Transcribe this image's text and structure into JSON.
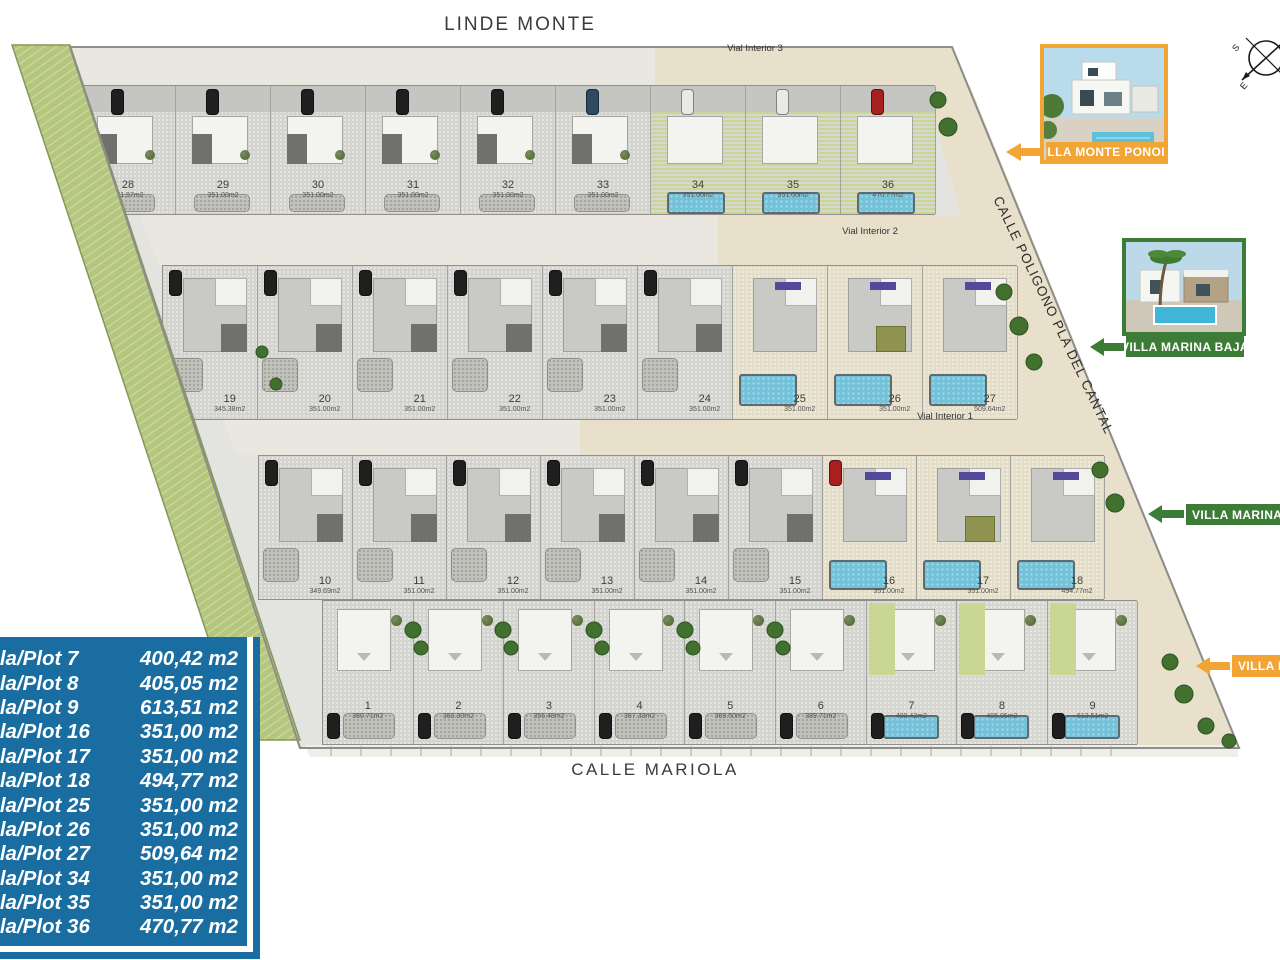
{
  "streets": {
    "top": "LINDE MONTE",
    "bottom": "CALLE MARIOLA",
    "right": "CALLE POLIGONO PLA DEL CANTAL"
  },
  "vials": {
    "v1": "Vial Interior 1",
    "v2": "Vial Interior 2",
    "v3": "Vial Interior 3"
  },
  "compass": {
    "letter_s": "S",
    "letter_e": "E"
  },
  "banners": {
    "monte_top": "VILLA MONTE PONOIG",
    "marina_top": "VILLA MARINA BAJA",
    "marina_side": "VILLA MARINA BAJA",
    "monte_side": "VILLA MONTE PONOIG"
  },
  "colors": {
    "orange": "#F2A434",
    "green": "#3D7C36",
    "legend_blue": "#1A6DA0",
    "pool": "#74C2DA",
    "lawn": "#C9D694"
  },
  "legend": {
    "rows": [
      {
        "label": "Parcela/Plot 7",
        "value": "400,42 m2"
      },
      {
        "label": "Parcela/Plot 8",
        "value": "405,05 m2"
      },
      {
        "label": "Parcela/Plot 9",
        "value": "613,51 m2"
      },
      {
        "label": "Parcela/Plot 16",
        "value": "351,00 m2"
      },
      {
        "label": "Parcela/Plot 17",
        "value": "351,00 m2"
      },
      {
        "label": "Parcela/Plot 18",
        "value": "494,77 m2"
      },
      {
        "label": "Parcela/Plot 25",
        "value": "351,00 m2"
      },
      {
        "label": "Parcela/Plot 26",
        "value": "351,00 m2"
      },
      {
        "label": "Parcela/Plot 27",
        "value": "509,64 m2"
      },
      {
        "label": "Parcela/Plot 34",
        "value": "351,00 m2"
      },
      {
        "label": "Parcela/Plot 35",
        "value": "351,00 m2"
      },
      {
        "label": "Parcela/Plot 36",
        "value": "470,77 m2"
      }
    ]
  },
  "plan": {
    "rows": [
      {
        "id": "row-28-36",
        "plots": [
          {
            "n": "28",
            "area": "371.97m2",
            "car": "#1f1f1f"
          },
          {
            "n": "29",
            "area": "351.00m2",
            "car": "#1f1f1f"
          },
          {
            "n": "30",
            "area": "351.00m2",
            "car": "#1f1f1f"
          },
          {
            "n": "31",
            "area": "351.00m2",
            "car": "#1f1f1f"
          },
          {
            "n": "32",
            "area": "351.00m2",
            "car": "#1f1f1f"
          },
          {
            "n": "33",
            "area": "351.00m2",
            "car": "#2e4a63"
          },
          {
            "n": "34",
            "area": "351.00m2",
            "car": "#e9e9e7",
            "green": true
          },
          {
            "n": "35",
            "area": "351.00m2",
            "car": "#e9e9e7",
            "green": true
          },
          {
            "n": "36",
            "area": "470.77m2",
            "car": "#a81f1f",
            "green": true
          }
        ]
      },
      {
        "id": "row-19-27",
        "plots": [
          {
            "n": "19",
            "area": "345.38m2",
            "car": "#1f1f1f"
          },
          {
            "n": "20",
            "area": "351.00m2",
            "car": "#1f1f1f"
          },
          {
            "n": "21",
            "area": "351.00m2",
            "car": "#1f1f1f"
          },
          {
            "n": "22",
            "area": "351.00m2",
            "car": "#1f1f1f"
          },
          {
            "n": "23",
            "area": "351.00m2",
            "car": "#1f1f1f"
          },
          {
            "n": "24",
            "area": "351.00m2",
            "car": "#1f1f1f"
          },
          {
            "n": "25",
            "area": "351.00m2",
            "green": true,
            "pergola": true
          },
          {
            "n": "26",
            "area": "351.00m2",
            "green": true,
            "pergola": true,
            "olive": true
          },
          {
            "n": "27",
            "area": "509.64m2",
            "green": true,
            "pergola": true
          }
        ]
      },
      {
        "id": "row-10-18",
        "plots": [
          {
            "n": "10",
            "area": "349.69m2",
            "car": "#1f1f1f"
          },
          {
            "n": "11",
            "area": "351.00m2",
            "car": "#1f1f1f"
          },
          {
            "n": "12",
            "area": "351.00m2",
            "car": "#1f1f1f"
          },
          {
            "n": "13",
            "area": "351.00m2",
            "car": "#1f1f1f"
          },
          {
            "n": "14",
            "area": "351.00m2",
            "car": "#1f1f1f"
          },
          {
            "n": "15",
            "area": "351.00m2",
            "car": "#1f1f1f"
          },
          {
            "n": "16",
            "area": "351.00m2",
            "green": true,
            "pergola": true,
            "car": "#a81f1f"
          },
          {
            "n": "17",
            "area": "351.00m2",
            "green": true,
            "pergola": true,
            "olive": true
          },
          {
            "n": "18",
            "area": "494.77m2",
            "green": true,
            "pergola": true
          }
        ]
      },
      {
        "id": "row-1-9",
        "plots": [
          {
            "n": "1",
            "area": "360.71m2",
            "car": "#1f1f1f"
          },
          {
            "n": "2",
            "area": "360.30m2",
            "car": "#1f1f1f"
          },
          {
            "n": "3",
            "area": "356.48m2",
            "car": "#1f1f1f"
          },
          {
            "n": "4",
            "area": "367.33m2",
            "car": "#1f1f1f"
          },
          {
            "n": "5",
            "area": "369.50m2",
            "car": "#1f1f1f"
          },
          {
            "n": "6",
            "area": "389.71m2",
            "car": "#1f1f1f"
          },
          {
            "n": "7",
            "area": "400.42m2",
            "car": "#1f1f1f",
            "green": true
          },
          {
            "n": "8",
            "area": "405.05m2",
            "car": "#1f1f1f",
            "green": true
          },
          {
            "n": "9",
            "area": "613.51m2",
            "car": "#1f1f1f",
            "green": true
          }
        ]
      }
    ]
  }
}
